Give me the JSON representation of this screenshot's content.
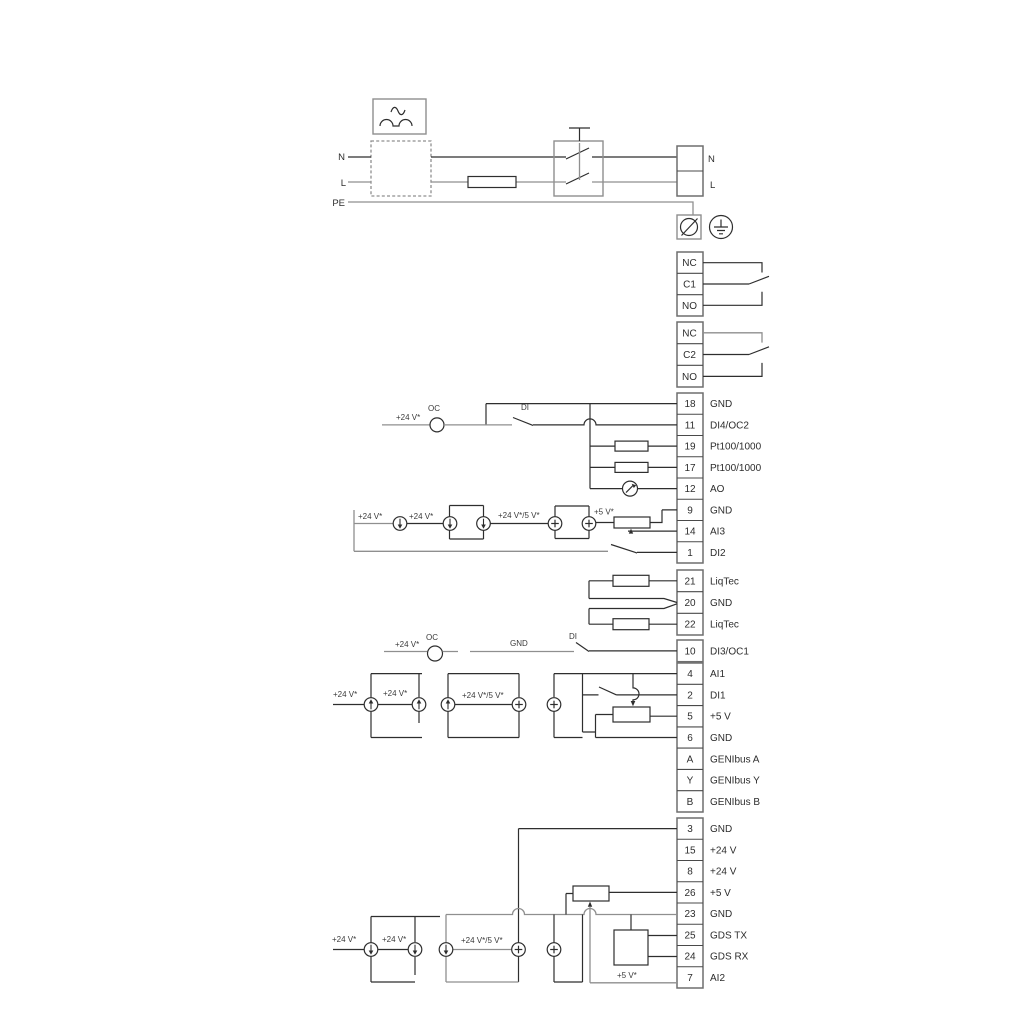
{
  "power": {
    "n_left": "N",
    "l_left": "L",
    "pe": "PE",
    "n_right": "N",
    "l_right": "L"
  },
  "relays": {
    "relay1": [
      "NC",
      "C1",
      "NO"
    ],
    "relay2": [
      "NC",
      "C2",
      "NO"
    ]
  },
  "strip_a": [
    {
      "id": "18",
      "label": "GND"
    },
    {
      "id": "11",
      "label": "DI4/OC2"
    },
    {
      "id": "19",
      "label": "Pt100/1000"
    },
    {
      "id": "17",
      "label": "Pt100/1000"
    },
    {
      "id": "12",
      "label": "AO"
    },
    {
      "id": "9",
      "label": "GND"
    },
    {
      "id": "14",
      "label": "AI3"
    },
    {
      "id": "1",
      "label": "DI2"
    }
  ],
  "liqtec": [
    {
      "id": "21",
      "label": "LiqTec"
    },
    {
      "id": "20",
      "label": "GND"
    },
    {
      "id": "22",
      "label": "LiqTec"
    }
  ],
  "t10": {
    "id": "10",
    "label": "DI3/OC1"
  },
  "strip_b": [
    {
      "id": "4",
      "label": "AI1"
    },
    {
      "id": "2",
      "label": "DI1"
    },
    {
      "id": "5",
      "label": "+5 V"
    },
    {
      "id": "6",
      "label": "GND"
    },
    {
      "id": "A",
      "label": "GENIbus A"
    },
    {
      "id": "Y",
      "label": "GENIbus Y"
    },
    {
      "id": "B",
      "label": "GENIbus B"
    }
  ],
  "strip_c": [
    {
      "id": "3",
      "label": "GND"
    },
    {
      "id": "15",
      "label": "+24 V"
    },
    {
      "id": "8",
      "label": "+24 V"
    },
    {
      "id": "26",
      "label": "+5 V"
    },
    {
      "id": "23",
      "label": "GND"
    },
    {
      "id": "25",
      "label": "GDS TX"
    },
    {
      "id": "24",
      "label": "GDS RX"
    },
    {
      "id": "7",
      "label": "AI2"
    }
  ],
  "wire_labels": {
    "v24": "+24 V*",
    "v24_5": "+24 V*/5 V*",
    "v5": "+5 V*",
    "oc": "OC",
    "di": "DI",
    "gnd": "GND"
  }
}
